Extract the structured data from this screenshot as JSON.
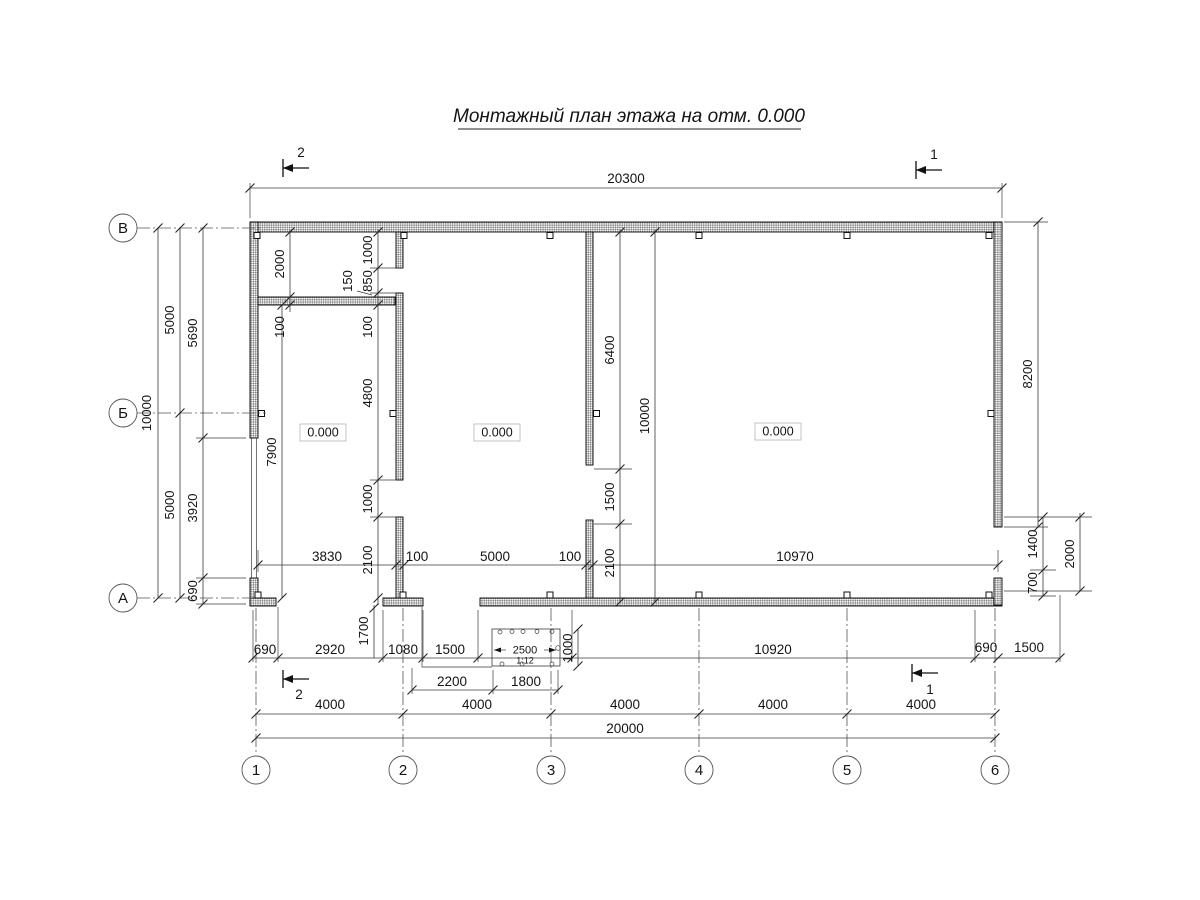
{
  "title": "Монтажный план этажа на отм. 0.000",
  "axes": {
    "rows": [
      "В",
      "Б",
      "А"
    ],
    "cols": [
      "1",
      "2",
      "3",
      "4",
      "5",
      "6"
    ]
  },
  "marks": {
    "top_left": "2",
    "top_right": "1",
    "bottom_left": "2",
    "bottom_right": "1"
  },
  "levels": {
    "room1": "0.000",
    "room2": "0.000",
    "room3": "0.000"
  },
  "dims": {
    "top_overall": "20300",
    "left": {
      "total": "10000",
      "upper": "5000",
      "lower": "5000",
      "wall": "5690",
      "opening": "3920",
      "corner": "690"
    },
    "room1": {
      "depth": "2000",
      "wall_t1": "100",
      "stub": "1000",
      "opening": "850",
      "gap": "150",
      "wall_t2": "100",
      "height": "7900"
    },
    "wall_a": {
      "upper": "4800",
      "door": "1000",
      "lower": "2100"
    },
    "wall_b": {
      "upper": "6400",
      "door": "1500",
      "lower": "2100",
      "total": "10000"
    },
    "right": {
      "wall": "8200",
      "opening": "1400",
      "corner": "700",
      "total": "2000"
    },
    "mid_row": {
      "r1": "3830",
      "t1": "100",
      "r2": "5000",
      "t2": "100",
      "r3": "10970"
    },
    "bottom_row": {
      "c690l": "690",
      "c2920": "2920",
      "c1080": "1080",
      "c1500": "1500",
      "c10920": "10920",
      "c690r": "690",
      "c1500r": "1500",
      "v1700": "1700"
    },
    "ramp": {
      "width": "2500",
      "slope": "1:12",
      "height": "1000"
    },
    "entry": {
      "left": "2200",
      "right": "1800"
    },
    "axis": {
      "spacings": [
        "4000",
        "4000",
        "4000",
        "4000",
        "4000"
      ],
      "total": "20000"
    }
  }
}
